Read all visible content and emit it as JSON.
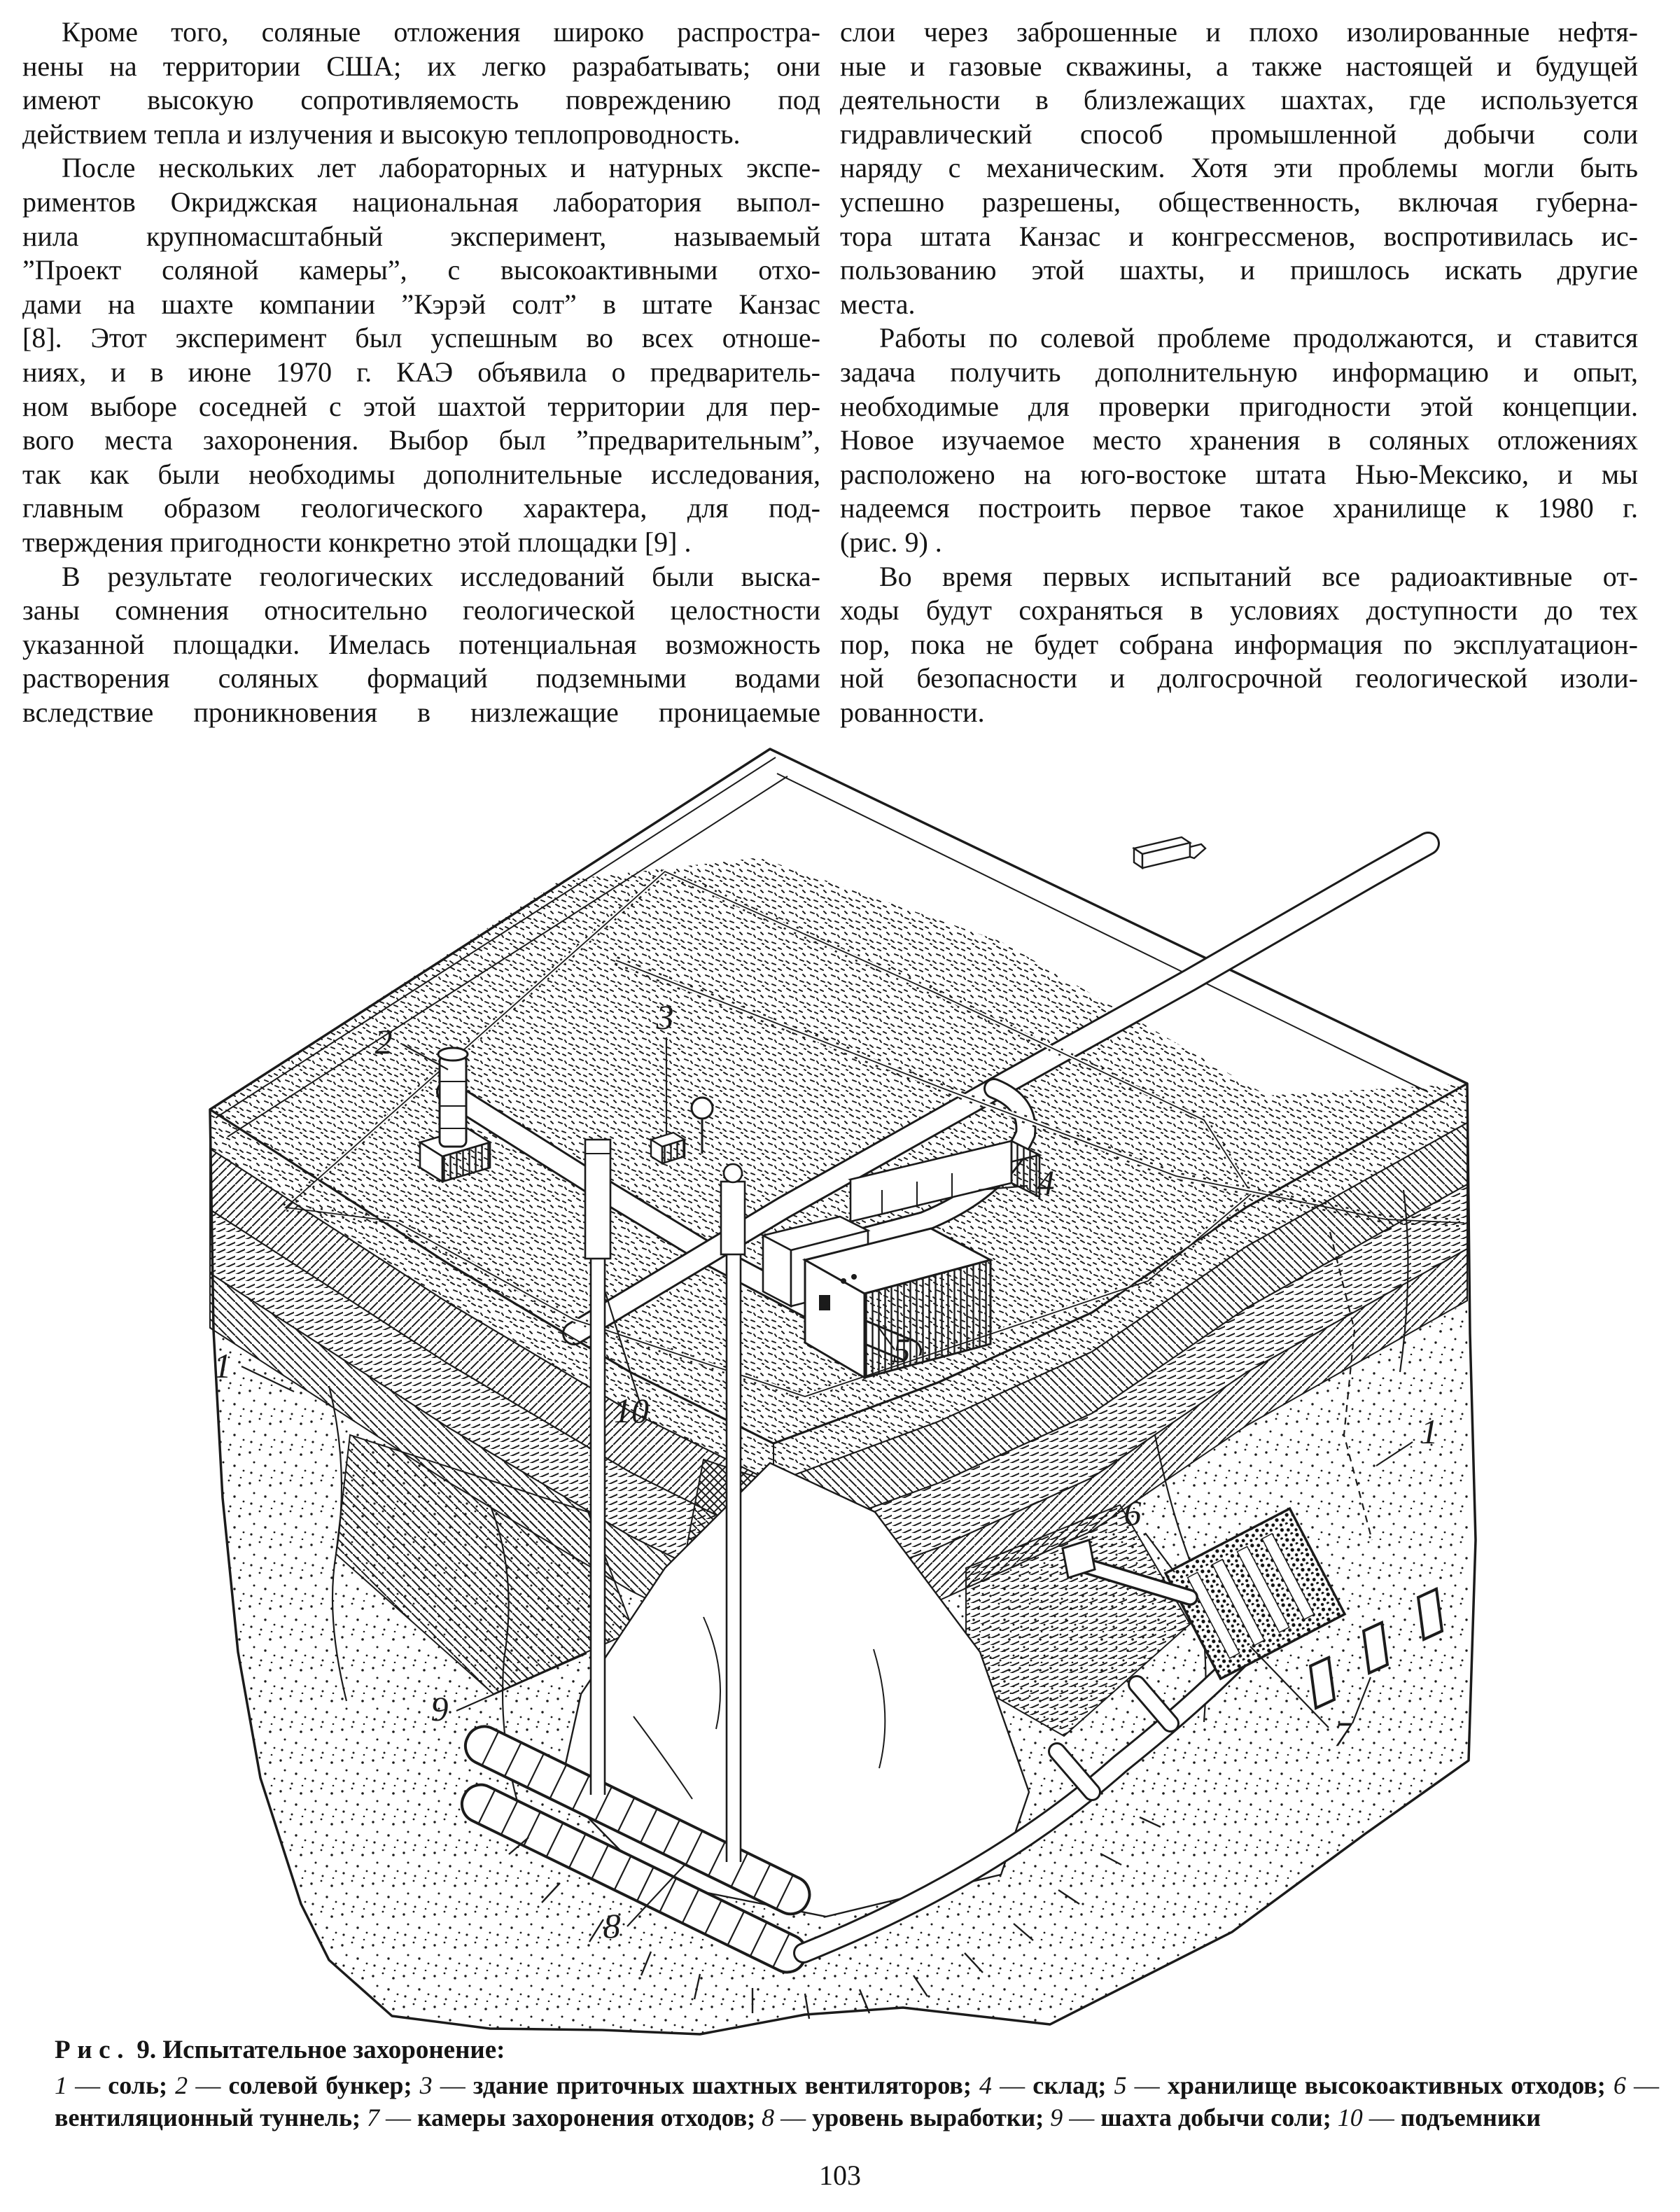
{
  "page": {
    "number": "103"
  },
  "columns": {
    "left": {
      "p1": [
        "Кроме того, соляные отложения широко распростра-",
        "нены на территории США; их легко разрабатывать; они",
        "имеют высокую сопротивляемость повреждению под",
        "действием тепла и излучения и высокую теплопроводность."
      ],
      "p2": [
        "После нескольких лет лабораторных и натурных экспе-",
        "риментов Окриджская национальная лаборатория выпол-",
        "нила крупномасштабный эксперимент, называемый",
        "”Проект соляной камеры”, с высокоактивными отхо-",
        "дами на шахте компании ”Кэрэй солт” в штате Канзас",
        "[8]. Этот эксперимент был успешным во всех отноше-",
        "ниях, и в июне 1970 г. КАЭ объявила о предваритель-",
        "ном выборе соседней с этой шахтой территории для пер-",
        "вого места захоронения. Выбор был ”предварительным”,",
        "так как были необходимы дополнительные исследования,",
        "главным образом геологического характера, для под-",
        "тверждения пригодности конкретно этой площадки [9] ."
      ],
      "p3": [
        "В результате геологических исследований были выска-",
        "заны сомнения относительно геологической целостности",
        "указанной площадки. Имелась потенциальная возможность",
        "растворения соляных формаций подземными водами",
        "вследствие проникновения в низлежащие проницаемые"
      ]
    },
    "right": {
      "p1": [
        "слои через заброшенные и плохо изолированные нефтя-",
        "ные и газовые скважины, а также настоящей и будущей",
        "деятельности в близлежащих шахтах, где используется",
        "гидравлический способ промышленной добычи соли",
        "наряду с механическим. Хотя эти проблемы могли быть",
        "успешно разрешены, общественность, включая губерна-",
        "тора штата Канзас и конгрессменов, воспротивилась ис-",
        "пользованию этой шахты, и пришлось искать другие",
        "места."
      ],
      "p2": [
        "Работы по солевой проблеме продолжаются, и ставится",
        "задача получить дополнительную информацию и опыт,",
        "необходимые для проверки пригодности этой концепции.",
        "Новое изучаемое место хранения в соляных отложениях",
        "расположено на юго-востоке штата Нью-Мексико, и мы",
        "надеемся построить первое такое хранилище к 1980 г.",
        "(рис. 9) ."
      ],
      "p3": [
        "Во время первых испытаний все радиоактивные от-",
        "ходы будут сохраняться в условиях доступности до тех",
        "пор, пока не будет собрана информация по эксплуатацион-",
        "ной безопасности и долгосрочной геологической изоли-",
        "рованности."
      ]
    }
  },
  "figure": {
    "caption": {
      "label_word": "Рис.",
      "label_num": "9.",
      "title": "Испытательное захоронение:"
    },
    "legend": [
      {
        "n": "1",
        "d": " — ",
        "t": "соль; "
      },
      {
        "n": "2",
        "d": " — ",
        "t": "солевой бункер; "
      },
      {
        "n": "3",
        "d": " — ",
        "t": "здание приточных шахтных вентиляторов; "
      },
      {
        "n": "4",
        "d": " — ",
        "t": "склад; "
      },
      {
        "n": "5",
        "d": " — ",
        "t": "хранилище высокоактивных отходов; "
      },
      {
        "n": "6",
        "d": " — ",
        "t": "вентиляционный туннель; "
      },
      {
        "n": "7",
        "d": " — ",
        "t": "камеры захоронения отходов; "
      },
      {
        "n": "8",
        "d": " — ",
        "t": "уровень выработки; "
      },
      {
        "n": "9",
        "d": " — ",
        "t": "шахта добычи соли; "
      },
      {
        "n": "10",
        "d": " — ",
        "t": "подъемники"
      }
    ],
    "callouts": [
      {
        "n": "1"
      },
      {
        "n": "2"
      },
      {
        "n": "3"
      },
      {
        "n": "4"
      },
      {
        "n": "5"
      },
      {
        "n": "6"
      },
      {
        "n": "7"
      },
      {
        "n": "8"
      },
      {
        "n": "9"
      },
      {
        "n": "10"
      },
      {
        "n": "1"
      }
    ]
  }
}
